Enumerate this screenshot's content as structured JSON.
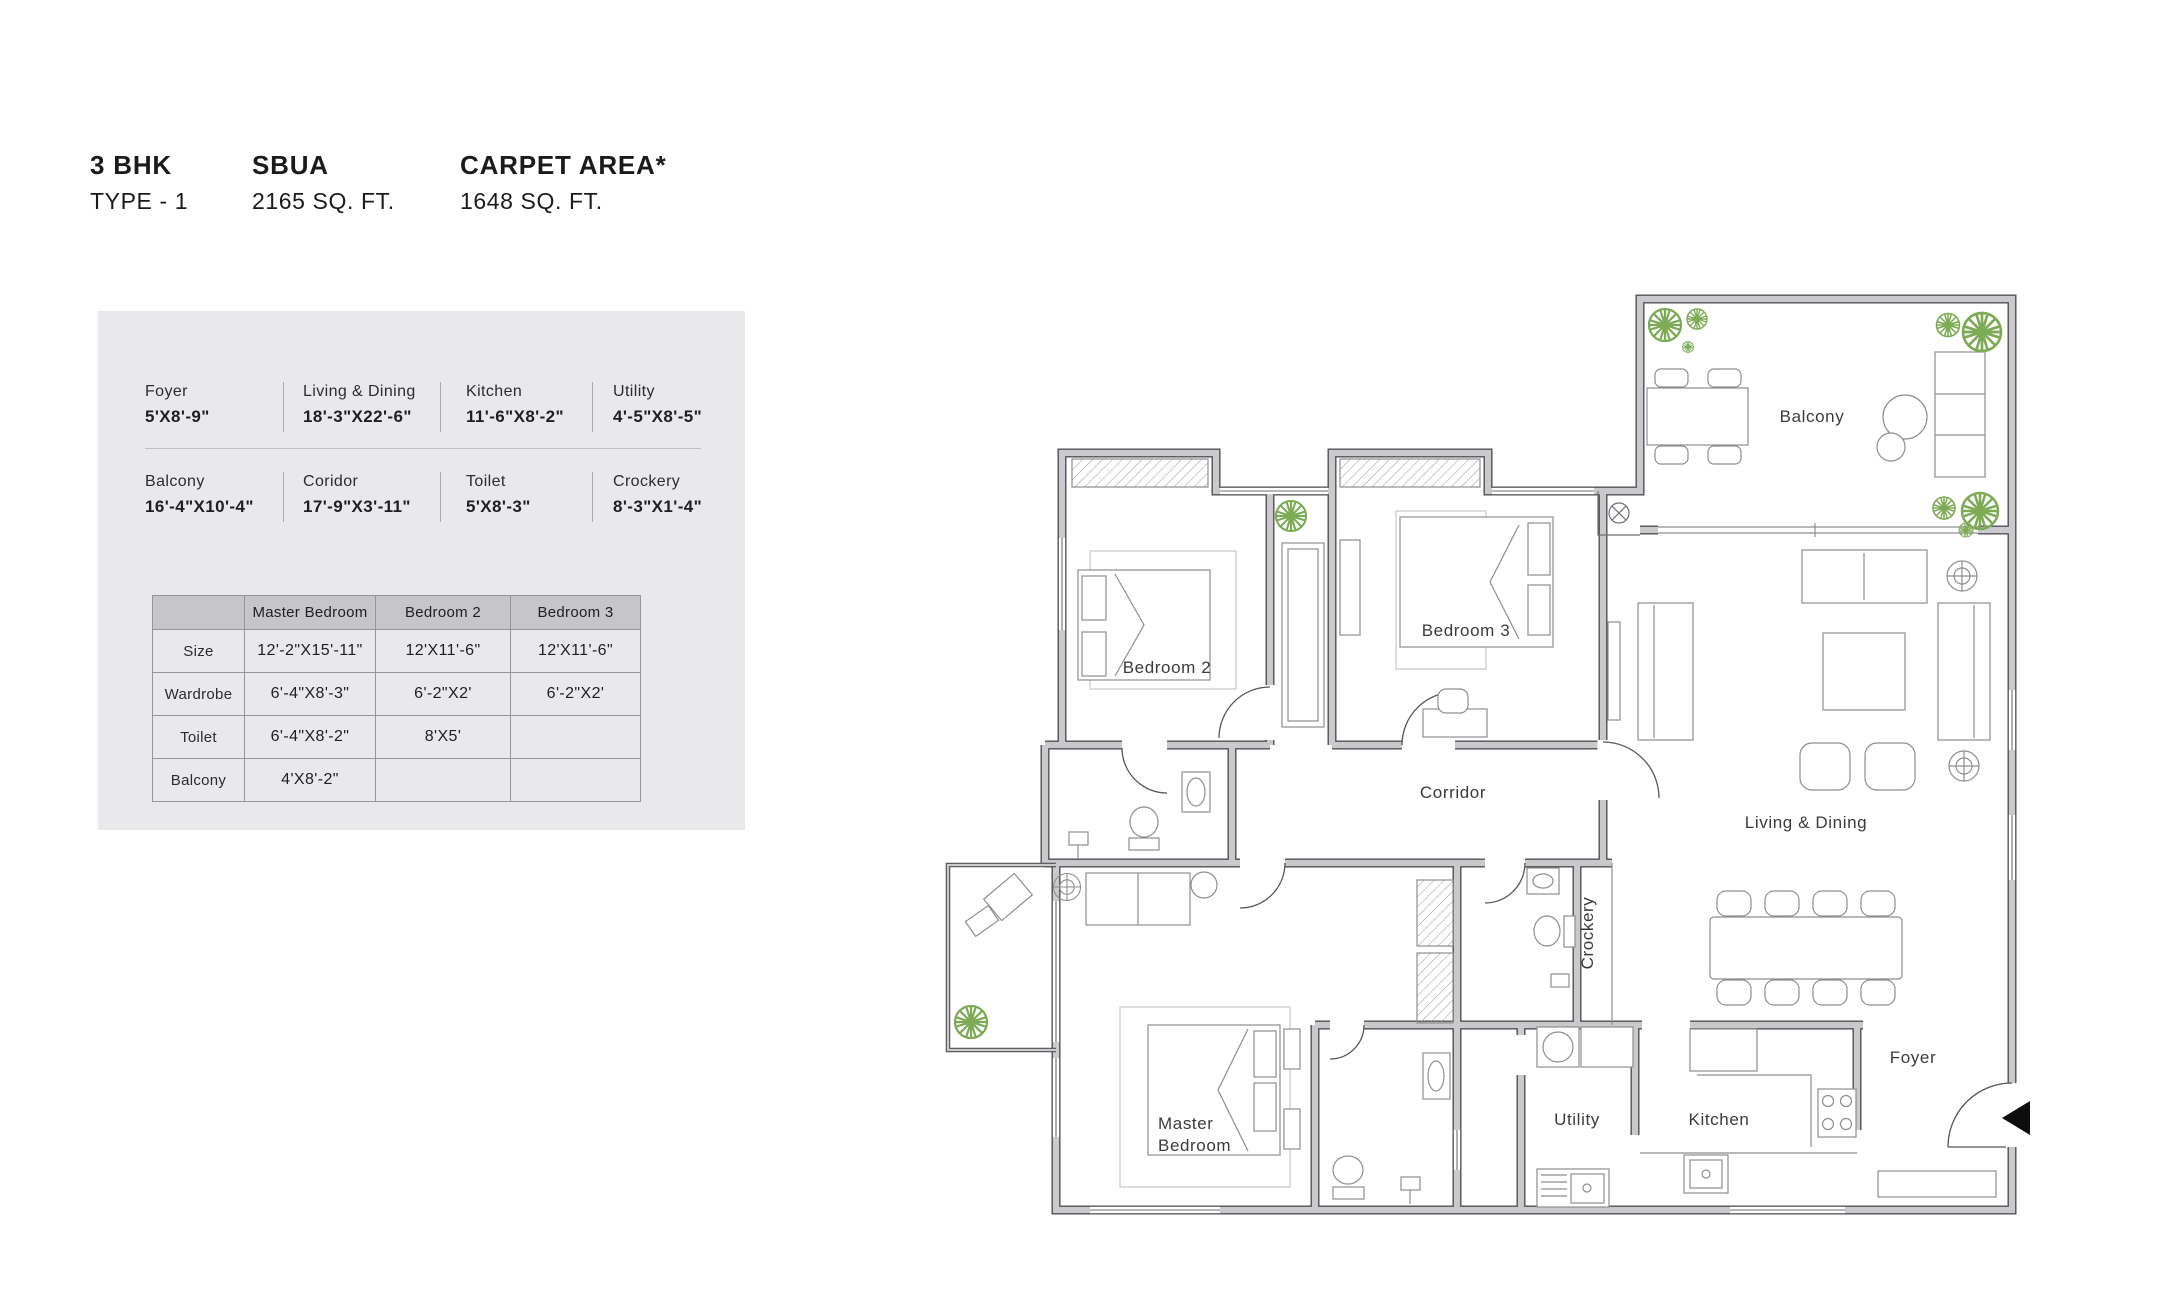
{
  "header": {
    "bhk": "3 BHK",
    "type": "TYPE - 1",
    "sbua_label": "SBUA",
    "sbua_value": "2165 SQ. FT.",
    "carpet_label": "CARPET AREA*",
    "carpet_value": "1648 SQ. FT."
  },
  "dimensions": {
    "rows": [
      [
        {
          "name": "Foyer",
          "size": "5'X8'-9\""
        },
        {
          "name": "Living & Dining",
          "size": "18'-3\"X22'-6\""
        },
        {
          "name": "Kitchen",
          "size": "11'-6\"X8'-2\""
        },
        {
          "name": "Utility",
          "size": "4'-5\"X8'-5\""
        }
      ],
      [
        {
          "name": "Balcony",
          "size": "16'-4\"X10'-4\""
        },
        {
          "name": "Coridor",
          "size": "17'-9\"X3'-11\""
        },
        {
          "name": "Toilet",
          "size": "5'X8'-3\""
        },
        {
          "name": "Crockery",
          "size": "8'-3\"X1'-4\""
        }
      ]
    ]
  },
  "table": {
    "headers": [
      "",
      "Master Bedroom",
      "Bedroom 2",
      "Bedroom 3"
    ],
    "rows": [
      {
        "label": "Size",
        "values": [
          "12'-2\"X15'-11\"",
          "12'X11'-6\"",
          "12'X11'-6\""
        ]
      },
      {
        "label": "Wardrobe",
        "values": [
          "6'-4\"X8'-3\"",
          "6'-2\"X2'",
          "6'-2\"X2'"
        ]
      },
      {
        "label": "Toilet",
        "values": [
          "6'-4\"X8'-2\"",
          "8'X5'",
          ""
        ]
      },
      {
        "label": "Balcony",
        "values": [
          "4'X8'-2\"",
          "",
          ""
        ]
      }
    ]
  },
  "plan": {
    "labels": {
      "bedroom2": "Bedroom 2",
      "bedroom3": "Bedroom 3",
      "balcony": "Balcony",
      "corridor": "Corridor",
      "living_dining": "Living & Dining",
      "crockery": "Crockery",
      "master_line1": "Master",
      "master_line2": "Bedroom",
      "utility": "Utility",
      "kitchen": "Kitchen",
      "foyer": "Foyer"
    },
    "colors": {
      "wall_fill": "#cacacc",
      "wall_edge": "#515155",
      "furniture_line": "#8e8e91",
      "plant_green": "#7dab55"
    }
  }
}
